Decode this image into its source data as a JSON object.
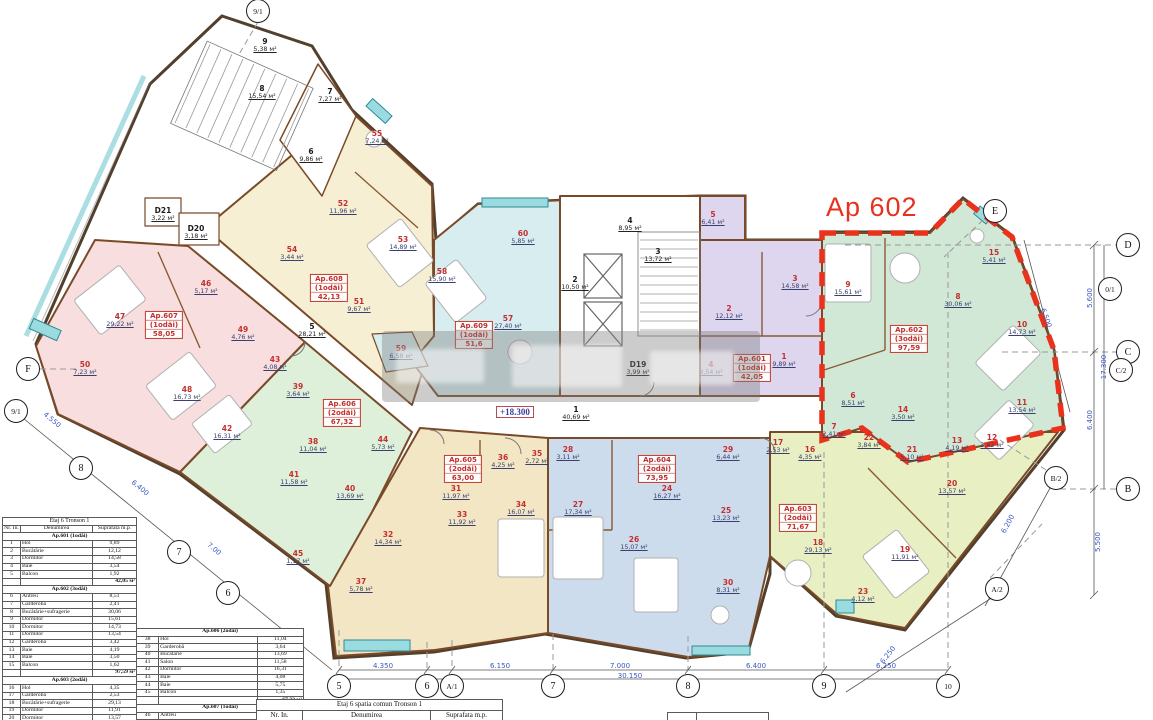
{
  "title": {
    "ap602_callout": "Ap 602",
    "level_mark": "+18.300"
  },
  "plan": {
    "unit_suffix": "м²",
    "apartments": [
      {
        "name": "Ap.601",
        "type": "(1odăi)",
        "total": "42,05",
        "label": {
          "x": 752,
          "y": 368
        },
        "rooms": [
          {
            "n": "1",
            "a": "9,89",
            "x": 784,
            "y": 360
          },
          {
            "n": "2",
            "a": "12,12",
            "x": 729,
            "y": 312
          },
          {
            "n": "3",
            "a": "14,58",
            "x": 795,
            "y": 282
          },
          {
            "n": "4",
            "a": "3,54",
            "x": 711,
            "y": 368
          },
          {
            "n": "5",
            "a": "6,41",
            "x": 713,
            "y": 218
          }
        ]
      },
      {
        "name": "Ap.602",
        "type": "(3odăi)",
        "total": "97,59",
        "label": {
          "x": 909,
          "y": 339
        },
        "rooms": [
          {
            "n": "6",
            "a": "8,51",
            "x": 853,
            "y": 399
          },
          {
            "n": "7",
            "a": "2,41",
            "x": 834,
            "y": 430
          },
          {
            "n": "8",
            "a": "30,06",
            "x": 958,
            "y": 300
          },
          {
            "n": "9",
            "a": "15,61",
            "x": 848,
            "y": 288
          },
          {
            "n": "10",
            "a": "14,73",
            "x": 1022,
            "y": 328
          },
          {
            "n": "11",
            "a": "13,54",
            "x": 1022,
            "y": 406
          },
          {
            "n": "12",
            "a": "3,42",
            "x": 992,
            "y": 441
          },
          {
            "n": "13",
            "a": "4,19",
            "x": 957,
            "y": 444
          },
          {
            "n": "14",
            "a": "3,50",
            "x": 903,
            "y": 413
          },
          {
            "n": "15",
            "a": "5,41",
            "x": 994,
            "y": 256
          }
        ]
      },
      {
        "name": "Ap.603",
        "type": "(2odăi)",
        "total": "71,67",
        "label": {
          "x": 798,
          "y": 518
        },
        "rooms": [
          {
            "n": "16",
            "a": "4,35",
            "x": 810,
            "y": 453
          },
          {
            "n": "17",
            "a": "2,53",
            "x": 778,
            "y": 446
          },
          {
            "n": "18",
            "a": "29,13",
            "x": 818,
            "y": 546
          },
          {
            "n": "19",
            "a": "11,91",
            "x": 905,
            "y": 553
          },
          {
            "n": "20",
            "a": "13,57",
            "x": 952,
            "y": 487
          },
          {
            "n": "21",
            "a": "5,10",
            "x": 912,
            "y": 453
          },
          {
            "n": "22",
            "a": "3,84",
            "x": 869,
            "y": 441
          },
          {
            "n": "23",
            "a": "4,12",
            "x": 863,
            "y": 595
          }
        ]
      },
      {
        "name": "Ap.604",
        "type": "(2odăi)",
        "total": "73,95",
        "label": {
          "x": 657,
          "y": 469
        },
        "rooms": [
          {
            "n": "24",
            "a": "16,27",
            "x": 667,
            "y": 492
          },
          {
            "n": "25",
            "a": "13,23",
            "x": 726,
            "y": 514
          },
          {
            "n": "26",
            "a": "15,07",
            "x": 634,
            "y": 543
          },
          {
            "n": "27",
            "a": "17,34",
            "x": 578,
            "y": 508
          },
          {
            "n": "28",
            "a": "3,11",
            "x": 568,
            "y": 453
          },
          {
            "n": "29",
            "a": "6,44",
            "x": 728,
            "y": 453
          },
          {
            "n": "30",
            "a": "8,31",
            "x": 728,
            "y": 586
          }
        ]
      },
      {
        "name": "Ap.605",
        "type": "(2odăi)",
        "total": "63,00",
        "label": {
          "x": 463,
          "y": 469
        },
        "rooms": [
          {
            "n": "31",
            "a": "11,97",
            "x": 456,
            "y": 492
          },
          {
            "n": "32",
            "a": "14,34",
            "x": 388,
            "y": 538
          },
          {
            "n": "33",
            "a": "11,92",
            "x": 462,
            "y": 518
          },
          {
            "n": "34",
            "a": "16,07",
            "x": 521,
            "y": 508
          },
          {
            "n": "35",
            "a": "2,72",
            "x": 537,
            "y": 457
          },
          {
            "n": "36",
            "a": "4,25",
            "x": 503,
            "y": 461
          },
          {
            "n": "37",
            "a": "5,78",
            "x": 361,
            "y": 585
          }
        ]
      },
      {
        "name": "Ap.606",
        "type": "(2odăi)",
        "total": "67,32",
        "label": {
          "x": 342,
          "y": 413
        },
        "rooms": [
          {
            "n": "38",
            "a": "11,04",
            "x": 313,
            "y": 445
          },
          {
            "n": "39",
            "a": "3,64",
            "x": 298,
            "y": 390
          },
          {
            "n": "40",
            "a": "13,69",
            "x": 350,
            "y": 492
          },
          {
            "n": "41",
            "a": "11,58",
            "x": 294,
            "y": 478
          },
          {
            "n": "42",
            "a": "16,31",
            "x": 227,
            "y": 432
          },
          {
            "n": "43",
            "a": "4,08",
            "x": 275,
            "y": 363
          },
          {
            "n": "44",
            "a": "5,73",
            "x": 383,
            "y": 443
          },
          {
            "n": "45",
            "a": "1,17",
            "x": 298,
            "y": 557
          }
        ]
      },
      {
        "name": "Ap.607",
        "type": "(1odăi)",
        "total": "58,05",
        "label": {
          "x": 164,
          "y": 325
        },
        "rooms": [
          {
            "n": "46",
            "a": "5,17",
            "x": 206,
            "y": 287
          },
          {
            "n": "47",
            "a": "29,22",
            "x": 120,
            "y": 320
          },
          {
            "n": "48",
            "a": "16,73",
            "x": 187,
            "y": 393
          },
          {
            "n": "49",
            "a": "4,76",
            "x": 243,
            "y": 333
          },
          {
            "n": "50",
            "a": "7,23",
            "x": 85,
            "y": 368
          }
        ]
      },
      {
        "name": "Ap.608",
        "type": "(1odăi)",
        "total": "42,13",
        "label": {
          "x": 329,
          "y": 288
        },
        "rooms": [
          {
            "n": "51",
            "a": "9,67",
            "x": 359,
            "y": 305
          },
          {
            "n": "52",
            "a": "11,96",
            "x": 343,
            "y": 207
          },
          {
            "n": "53",
            "a": "14,89",
            "x": 403,
            "y": 243
          },
          {
            "n": "54",
            "a": "3,44",
            "x": 292,
            "y": 253
          },
          {
            "n": "55",
            "a": "7,24",
            "x": 377,
            "y": 137
          }
        ]
      },
      {
        "name": "Ap.609",
        "type": "(1odăi)",
        "total": "51,6",
        "label": {
          "x": 474,
          "y": 335
        },
        "rooms": [
          {
            "n": "57",
            "a": "27,40",
            "x": 508,
            "y": 322
          },
          {
            "n": "58",
            "a": "15,90",
            "x": 442,
            "y": 275
          },
          {
            "n": "59",
            "a": "6,58",
            "x": 401,
            "y": 352
          },
          {
            "n": "60",
            "a": "5,85",
            "x": 523,
            "y": 237
          }
        ]
      }
    ],
    "common_rooms": [
      {
        "n": "1",
        "a": "40,69",
        "x": 576,
        "y": 413
      },
      {
        "n": "2",
        "a": "10,50",
        "x": 575,
        "y": 283
      },
      {
        "n": "3",
        "a": "13,72",
        "x": 658,
        "y": 255
      },
      {
        "n": "4",
        "a": "8,95",
        "x": 630,
        "y": 224
      },
      {
        "n": "5",
        "a": "28,21",
        "x": 312,
        "y": 330
      },
      {
        "n": "6",
        "a": "9,86",
        "x": 311,
        "y": 155
      },
      {
        "n": "7",
        "a": "7,27",
        "x": 330,
        "y": 95
      },
      {
        "n": "8",
        "a": "15,54",
        "x": 262,
        "y": 92
      },
      {
        "n": "9",
        "a": "5,38",
        "x": 265,
        "y": 45
      },
      {
        "n": "D19",
        "a": "3,99",
        "x": 638,
        "y": 368
      },
      {
        "n": "D20",
        "a": "3,18",
        "x": 196,
        "y": 232
      },
      {
        "n": "D21",
        "a": "3,22",
        "x": 163,
        "y": 214
      }
    ],
    "axes": [
      {
        "label": "9/1",
        "x": 258,
        "y": 11
      },
      {
        "label": "E",
        "x": 995,
        "y": 211
      },
      {
        "label": "D",
        "x": 1128,
        "y": 245
      },
      {
        "label": "0/1",
        "x": 1110,
        "y": 289
      },
      {
        "label": "C",
        "x": 1128,
        "y": 352
      },
      {
        "label": "C/2",
        "x": 1121,
        "y": 370
      },
      {
        "label": "B/2",
        "x": 1056,
        "y": 478
      },
      {
        "label": "B",
        "x": 1128,
        "y": 489
      },
      {
        "label": "A/2",
        "x": 997,
        "y": 589
      },
      {
        "label": "F",
        "x": 28,
        "y": 369
      },
      {
        "label": "9/1",
        "x": 16,
        "y": 411
      },
      {
        "label": "8",
        "x": 81,
        "y": 468
      },
      {
        "label": "7",
        "x": 179,
        "y": 552
      },
      {
        "label": "6",
        "x": 228,
        "y": 593
      },
      {
        "label": "5",
        "x": 339,
        "y": 686
      },
      {
        "label": "6",
        "x": 427,
        "y": 686
      },
      {
        "label": "A/1",
        "x": 452,
        "y": 686
      },
      {
        "label": "7",
        "x": 553,
        "y": 686
      },
      {
        "label": "8",
        "x": 688,
        "y": 686
      },
      {
        "label": "9",
        "x": 824,
        "y": 686
      },
      {
        "label": "10",
        "x": 948,
        "y": 686
      }
    ],
    "dimensions": [
      {
        "t": "4.350",
        "x": 383,
        "y": 666,
        "r": 0
      },
      {
        "t": "6.150",
        "x": 500,
        "y": 666,
        "r": 0
      },
      {
        "t": "7.000",
        "x": 620,
        "y": 666,
        "r": 0
      },
      {
        "t": "6.400",
        "x": 756,
        "y": 666,
        "r": 0
      },
      {
        "t": "6.250",
        "x": 886,
        "y": 666,
        "r": 0
      },
      {
        "t": "30.150",
        "x": 630,
        "y": 676,
        "r": 0
      },
      {
        "t": "5.600",
        "x": 1090,
        "y": 298,
        "r": -90
      },
      {
        "t": "6.400",
        "x": 1090,
        "y": 420,
        "r": -90
      },
      {
        "t": "17.300",
        "x": 1104,
        "y": 367,
        "r": -90
      },
      {
        "t": "6.500",
        "x": 1046,
        "y": 318,
        "r": 70
      },
      {
        "t": "5.500",
        "x": 1098,
        "y": 542,
        "r": -90
      },
      {
        "t": "6.200",
        "x": 1008,
        "y": 524,
        "r": -62
      },
      {
        "t": "6.250",
        "x": 888,
        "y": 655,
        "r": -52
      },
      {
        "t": "4.550",
        "x": 52,
        "y": 420,
        "r": 40
      },
      {
        "t": "6.400",
        "x": 140,
        "y": 488,
        "r": 40
      },
      {
        "t": "7.00",
        "x": 214,
        "y": 549,
        "r": 40
      }
    ]
  },
  "tables": {
    "table1": {
      "title": "Etaj 6 Tronson 1",
      "col_headers": [
        "Nr. In.",
        "Denumirea",
        "Suprafata m.p."
      ],
      "sections": [
        {
          "header": "Ap.601 (1odăi)",
          "total": "42,05 м²",
          "rows": [
            [
              "1",
              "Hol",
              "9,89"
            ],
            [
              "2",
              "Bucătărie",
              "12,12"
            ],
            [
              "3",
              "Dormitor",
              "14,58"
            ],
            [
              "4",
              "Baie",
              "3,54"
            ],
            [
              "5",
              "Balcon",
              "1,92"
            ]
          ]
        },
        {
          "header": "Ap.602 (3odăi)",
          "total": "97,59 м²",
          "rows": [
            [
              "6",
              "Antreu",
              "8,51"
            ],
            [
              "7",
              "Garderobă",
              "2,41"
            ],
            [
              "8",
              "Bucătărie+sufragerie",
              "30,06"
            ],
            [
              "9",
              "Dormitor",
              "15,61"
            ],
            [
              "10",
              "Dormitor",
              "14,73"
            ],
            [
              "11",
              "Dormitor",
              "13,54"
            ],
            [
              "12",
              "Garderobă",
              "3,42"
            ],
            [
              "13",
              "Baie",
              "4,19"
            ],
            [
              "14",
              "Baie",
              "3,50"
            ],
            [
              "15",
              "Balcon",
              "1,62"
            ]
          ]
        },
        {
          "header": "Ap.603 (2odăi)",
          "total": "71,67 м²",
          "rows": [
            [
              "16",
              "Hol",
              "4,35"
            ],
            [
              "17",
              "Garderobă",
              "2,53"
            ],
            [
              "18",
              "Bucătărie+sufragerie",
              "29,13"
            ],
            [
              "19",
              "Dormitor",
              "11,91"
            ],
            [
              "20",
              "Dormitor",
              "13,57"
            ],
            [
              "21",
              "Baie",
              "5,10"
            ],
            [
              "22",
              "Baie",
              "3,84"
            ],
            [
              "23",
              "Balcon",
              "1,24"
            ]
          ]
        }
      ]
    },
    "table2": {
      "title": null,
      "col_headers": null,
      "sections": [
        {
          "header": "Ap.606 (2odăi)",
          "total": "67,32 м²",
          "rows": [
            [
              "38",
              "Hol",
              "11,04"
            ],
            [
              "39",
              "Garderobă",
              "3,64"
            ],
            [
              "40",
              "Bucătărie",
              "13,69"
            ],
            [
              "41",
              "Salon",
              "11,58"
            ],
            [
              "42",
              "Dormitor",
              "16,31"
            ],
            [
              "43",
              "Baie",
              "4,08"
            ],
            [
              "44",
              "Baie",
              "5,75"
            ],
            [
              "45",
              "Balcon",
              "1,35"
            ]
          ]
        },
        {
          "header": "Ap.607 (1odăi)",
          "total": null,
          "rows": [
            [
              "46",
              "Antreu",
              "5,17"
            ],
            [
              "47",
              "Bucătărie+Sufragerie",
              "29,22"
            ],
            [
              "48",
              "Dormitor",
              "16,73"
            ]
          ]
        }
      ]
    },
    "table3": {
      "title": "Etaj 6 spatia comun Tronson 1",
      "col_headers": [
        "Nr. In.",
        "Denumirea",
        "Suprafata m.p."
      ],
      "sections": []
    }
  }
}
